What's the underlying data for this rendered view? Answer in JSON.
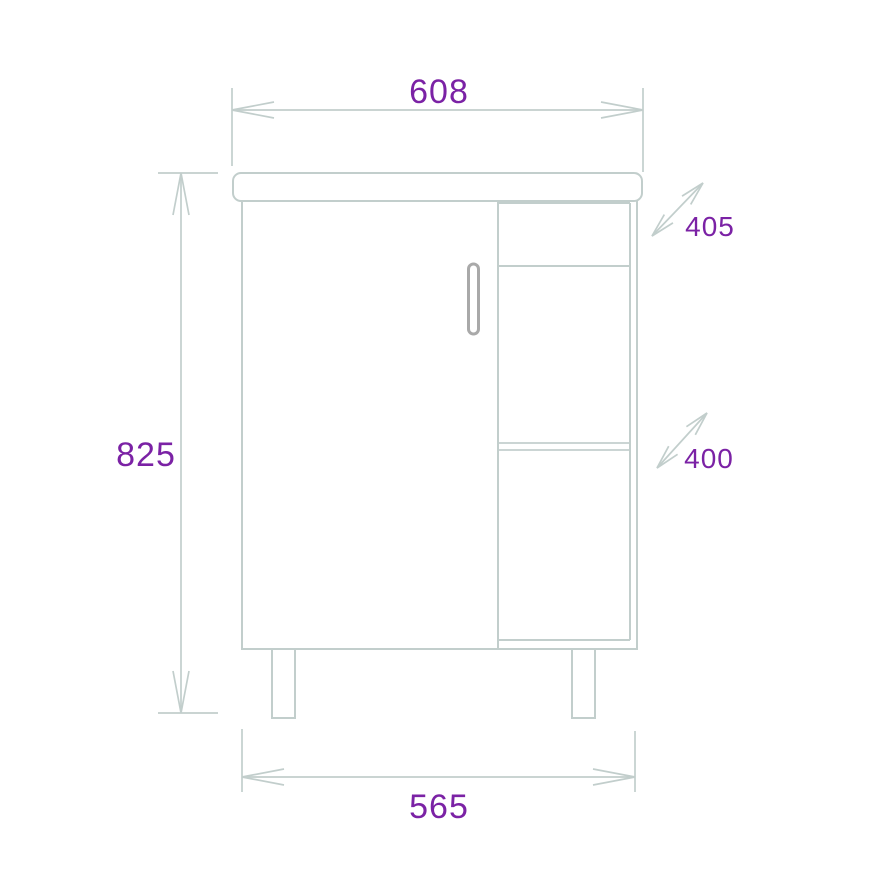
{
  "dimensions": [
    {
      "name": "overall-width-top",
      "label": "608"
    },
    {
      "name": "overall-height",
      "label": "825"
    },
    {
      "name": "upper-section-depth",
      "label": "405"
    },
    {
      "name": "lower-shelf-depth",
      "label": "400"
    },
    {
      "name": "cabinet-width-bottom",
      "label": "565"
    }
  ],
  "colors": {
    "line": "#c2cecc",
    "dimension_text": "#7b22a5",
    "handle": "#a9a9a9",
    "background": "#ffffff"
  }
}
